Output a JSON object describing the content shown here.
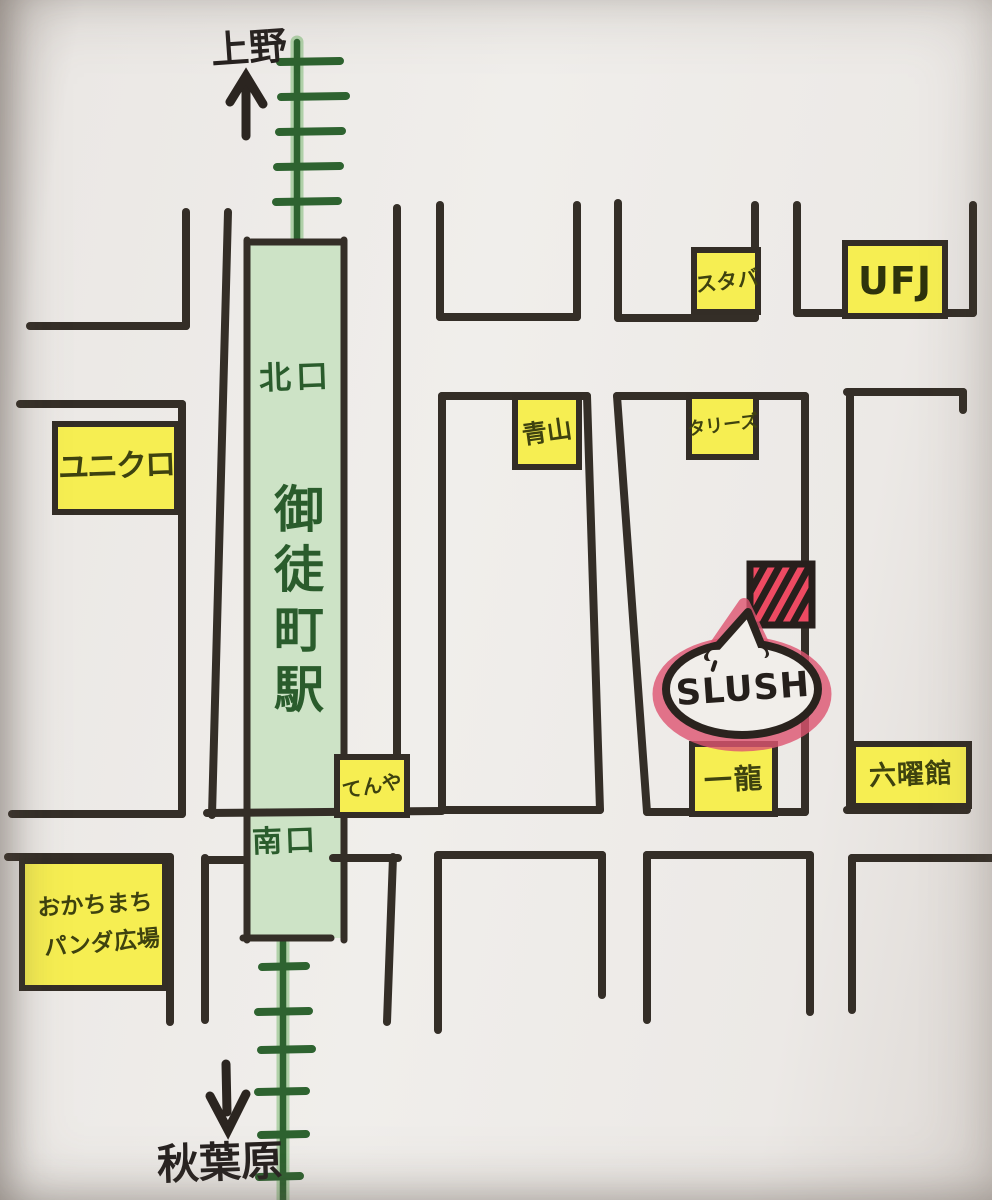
{
  "map": {
    "kind": "hand-drawn-directions-map",
    "directions": {
      "north": "上野",
      "south": "秋葉原"
    },
    "station": {
      "name": "御徒町駅",
      "north_exit": "北口",
      "south_exit": "南口"
    },
    "destination": {
      "label": "SLUSH"
    },
    "landmarks": [
      {
        "id": "uniqlo",
        "label": "ユニクロ"
      },
      {
        "id": "starbucks",
        "label": "スタバ"
      },
      {
        "id": "ufj",
        "label": "UFJ"
      },
      {
        "id": "aoyama",
        "label": "青山"
      },
      {
        "id": "tullys",
        "label": "タリーズ"
      },
      {
        "id": "tenya",
        "label": "てんや"
      },
      {
        "id": "ichiryu",
        "label": "一龍"
      },
      {
        "id": "rokuyokan",
        "label": "六曜館"
      },
      {
        "id": "panda-plaza",
        "label_line1": "おかちまち",
        "label_line2": "パンダ広場"
      }
    ],
    "colors": {
      "paper": "#efecea",
      "street_ink": "#342e27",
      "rail_green_dark": "#2e6330",
      "rail_green_light": "#9bc893",
      "station_fill": "#cde3c6",
      "landmark_yellow": "#f6ee52",
      "destination_red": "#ee4a62",
      "bubble_red": "#dd5470"
    }
  }
}
